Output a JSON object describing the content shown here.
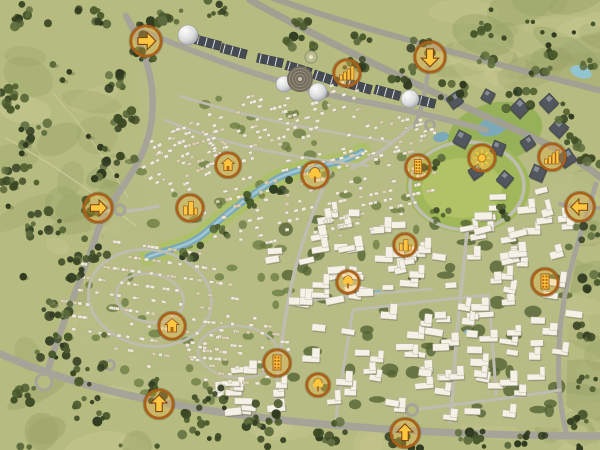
{
  "map": {
    "name": "community-masterplan-aerial-map",
    "colors": {
      "field": "#b4ba7e",
      "field_light": "#c6c992",
      "field_dark": "#94a066",
      "road": "#a3a298",
      "road_light": "#bcbcb0",
      "water": "#76a7bc",
      "water_light": "#a9d0dc",
      "marker_ring": "#a85a12",
      "marker_fill": "rgba(252,177,44,0.28)",
      "glyph": "#ffc63a",
      "office": "#4a505b",
      "commercial": "#3d4450",
      "villa": "#f0ebdd",
      "apartment": "#f6f3ea"
    },
    "markers": [
      {
        "name": "entrance-marker-northwest",
        "icon": "arrow-icon",
        "dir": "right",
        "x": 146,
        "y": 41,
        "r": 15
      },
      {
        "name": "entrance-marker-north",
        "icon": "arrow-icon",
        "dir": "down",
        "x": 430,
        "y": 57,
        "r": 15
      },
      {
        "name": "business-district-marker-north",
        "icon": "bar-buildings-icon",
        "x": 347,
        "y": 73,
        "r": 13
      },
      {
        "name": "business-district-marker-east",
        "icon": "bar-buildings-icon",
        "x": 552,
        "y": 157,
        "r": 13
      },
      {
        "name": "entrance-marker-east",
        "icon": "arrow-icon",
        "dir": "left",
        "x": 580,
        "y": 207,
        "r": 14
      },
      {
        "name": "central-park-marker",
        "icon": "sun-icon",
        "x": 482,
        "y": 158,
        "r": 13
      },
      {
        "name": "tower-marker-central",
        "icon": "tower-icon",
        "x": 418,
        "y": 167,
        "r": 12
      },
      {
        "name": "park-marker-central",
        "icon": "tree-icon",
        "x": 315,
        "y": 175,
        "r": 13
      },
      {
        "name": "entrance-marker-west",
        "icon": "arrow-icon",
        "dir": "right",
        "x": 98,
        "y": 208,
        "r": 14
      },
      {
        "name": "village-center-marker-west",
        "icon": "buildings-icon",
        "x": 190,
        "y": 208,
        "r": 13
      },
      {
        "name": "clubhouse-marker-north",
        "icon": "house-icon",
        "x": 228,
        "y": 165,
        "r": 12
      },
      {
        "name": "clubhouse-marker-southwest",
        "icon": "house-icon",
        "x": 172,
        "y": 326,
        "r": 13
      },
      {
        "name": "tower-marker-south",
        "icon": "tower-icon",
        "x": 277,
        "y": 363,
        "r": 13
      },
      {
        "name": "entrance-marker-southwest",
        "icon": "arrow-icon",
        "dir": "up",
        "x": 159,
        "y": 404,
        "r": 14
      },
      {
        "name": "park-marker-center-south",
        "icon": "tree-icon",
        "x": 348,
        "y": 282,
        "r": 11
      },
      {
        "name": "village-center-marker-central",
        "icon": "buildings-icon",
        "x": 405,
        "y": 245,
        "r": 11
      },
      {
        "name": "tower-marker-east",
        "icon": "tower-icon",
        "x": 545,
        "y": 282,
        "r": 13
      },
      {
        "name": "park-marker-south",
        "icon": "tree-icon",
        "x": 318,
        "y": 385,
        "r": 11
      },
      {
        "name": "entrance-marker-south",
        "icon": "arrow-icon",
        "dir": "up",
        "x": 405,
        "y": 433,
        "r": 14
      }
    ],
    "landmarks": [
      {
        "name": "dome-building-west",
        "x": 188,
        "y": 35,
        "r": 10
      },
      {
        "name": "dome-building-center-left",
        "x": 284,
        "y": 84,
        "r": 8
      },
      {
        "name": "dome-building-center",
        "x": 318,
        "y": 92,
        "r": 9
      },
      {
        "name": "dome-building-east",
        "x": 410,
        "y": 99,
        "r": 9
      },
      {
        "name": "amphitheater",
        "x": 300,
        "y": 79,
        "r": 13
      }
    ]
  }
}
